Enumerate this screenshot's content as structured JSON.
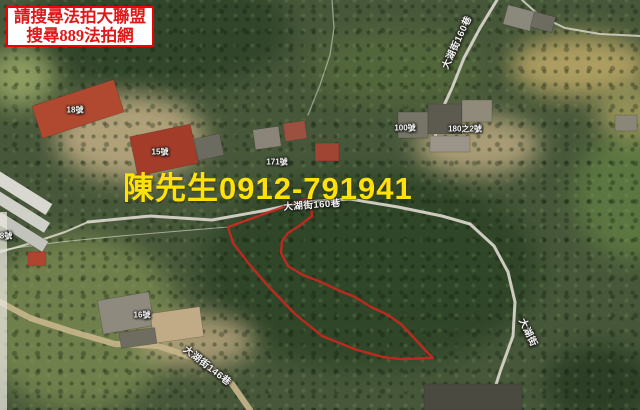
{
  "banner": {
    "line1": "請搜尋法拍大聯盟",
    "line2": "搜尋889法拍網",
    "text_color": "#e01818",
    "border_color": "#f00000"
  },
  "contact": {
    "name_phone": "陳先生0912-791941",
    "color": "#ffe10a"
  },
  "parcel": {
    "color": "#c8281e",
    "points": "228,227 297,202 310,198 312,216 299,226 288,233 282,241 281,253 288,266 303,275 321,282 338,290 355,297 371,307 388,315 402,325 414,338 426,351 433,358 400,359 383,357 357,350 322,336 295,314 269,287 249,264 233,243"
  },
  "map": {
    "road_labels": [
      {
        "text": "大湖街160巷"
      },
      {
        "text": "大湖街160巷"
      },
      {
        "text": "大湖街146巷"
      },
      {
        "text": "大湖街"
      }
    ],
    "house_labels": [
      {
        "text": "18號"
      },
      {
        "text": "15號"
      },
      {
        "text": "171號"
      },
      {
        "text": "100號"
      },
      {
        "text": "180之2號"
      },
      {
        "text": "8號"
      },
      {
        "text": "16號"
      }
    ]
  }
}
